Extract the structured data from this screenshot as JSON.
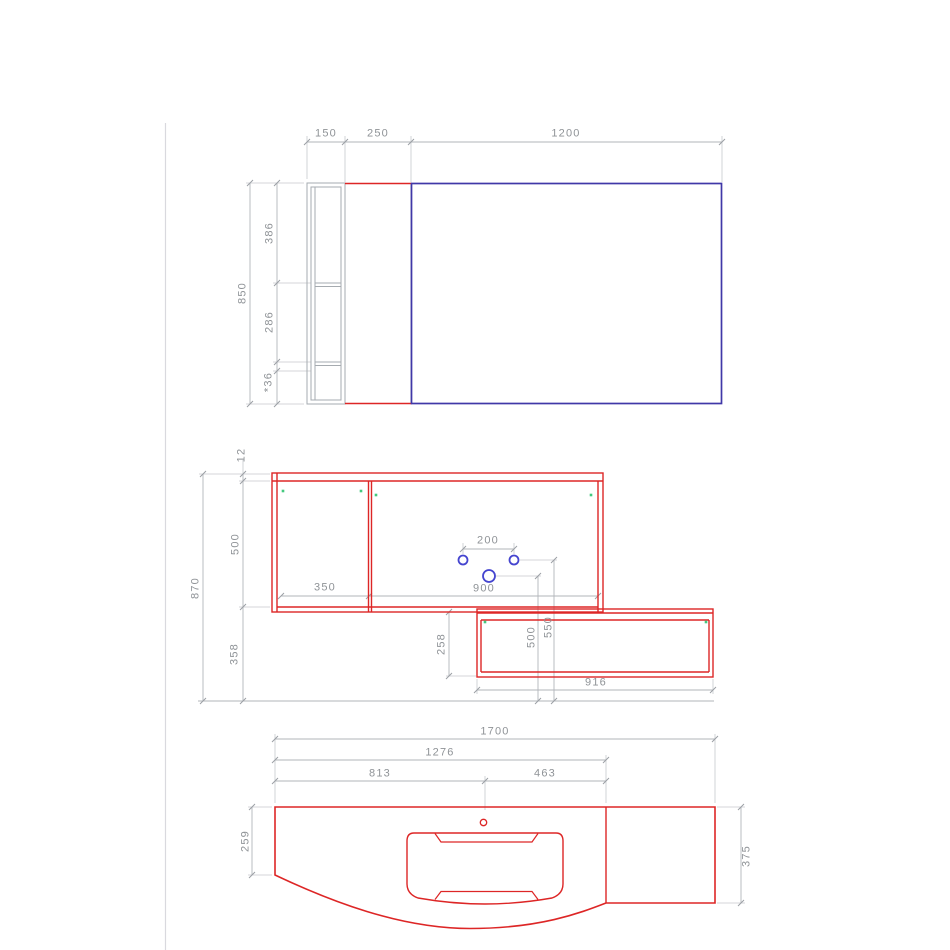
{
  "drawing_title": "vanity unit technical drawing",
  "colors": {
    "furniture_red": "#dd2626",
    "mirror_blue": "#4038a8",
    "hole_blue": "#4545cf",
    "hinge_green": "#44c97e",
    "dimension_gray": "#b2b5ba",
    "text_gray": "#8f9397",
    "cabinet_gray": "#a6abb0",
    "page_line": "#d9d9de"
  },
  "views": {
    "front_upper": {
      "name": "upper mirror unit - front view",
      "dims": {
        "w_side": "150",
        "w_panel": "250",
        "w_mirror": "1200",
        "h_total": "850",
        "seg_top": "386",
        "seg_mid": "286",
        "seg_bottom": "*36"
      }
    },
    "front_vanity": {
      "name": "vanity cabinets - front view",
      "dims": {
        "top_thickness": "12",
        "cabinet_height": "500",
        "clearance_below": "358",
        "total_height": "870",
        "left_door_width": "350",
        "right_door_width": "900",
        "hole_spacing": "200",
        "large_hole_height": "500",
        "small_hole_height": "550",
        "drawer_height": "258",
        "drawer_width": "916"
      }
    },
    "plan_countertop": {
      "name": "countertop - plan view",
      "dims": {
        "total_width": "1700",
        "width_to_divider": "1276",
        "left_to_center": "813",
        "center_to_divider": "463",
        "left_depth": "259",
        "right_depth": "375"
      }
    }
  }
}
